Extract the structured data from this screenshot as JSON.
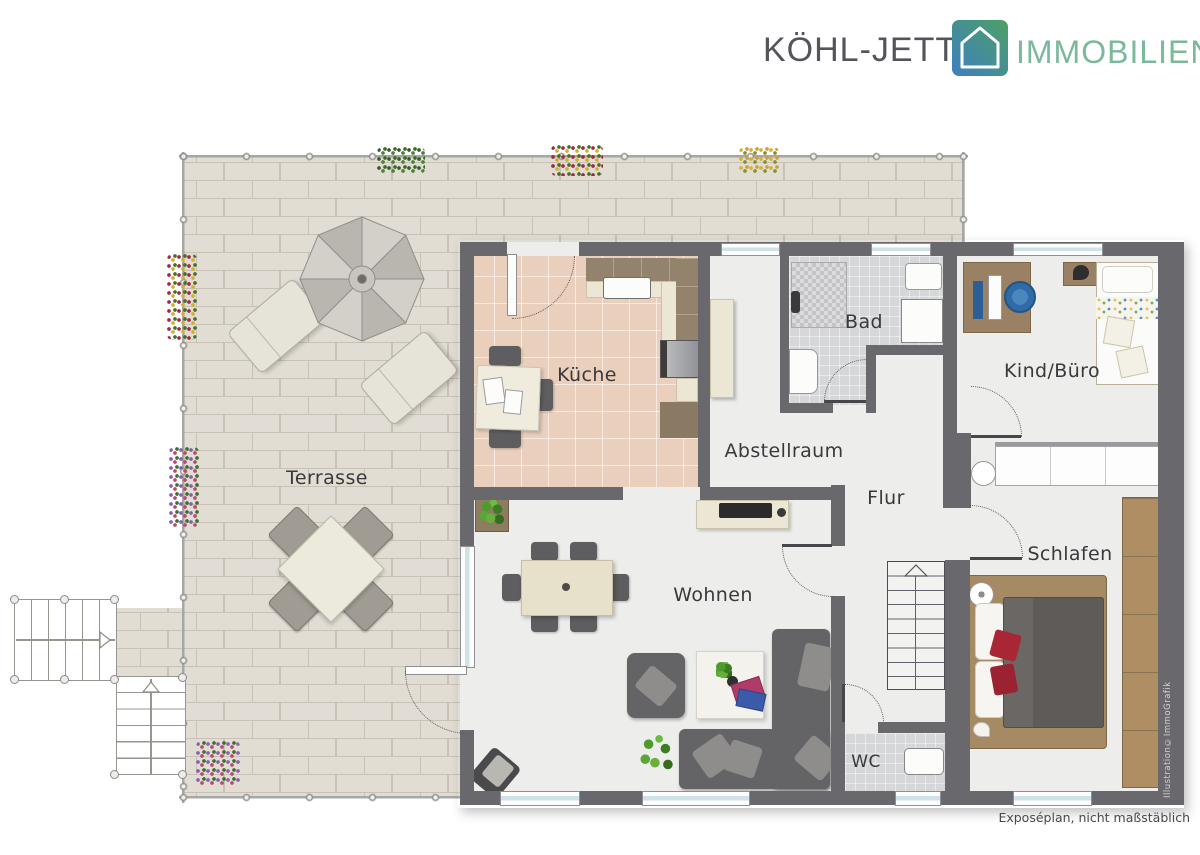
{
  "meta": {
    "width": 1200,
    "height": 855,
    "kind": "real-estate floor plan"
  },
  "logo": {
    "brand": "KÖHL-JETTER",
    "suffix": "IMMOBILIEN",
    "colors": {
      "brand_text": "#54555a",
      "suffix_text": "#7bb89c",
      "icon_gradient_start": "#3e7fc0",
      "icon_gradient_end": "#4d9f66"
    }
  },
  "floor_plan": {
    "wall_color": "#69686d",
    "label_color": "#39393b",
    "rooms": [
      {
        "id": "terrasse",
        "label": "Terrasse"
      },
      {
        "id": "kueche",
        "label": "Küche"
      },
      {
        "id": "bad",
        "label": "Bad"
      },
      {
        "id": "kind_buero",
        "label": "Kind/Büro"
      },
      {
        "id": "abstellraum",
        "label": "Abstellraum"
      },
      {
        "id": "flur",
        "label": "Flur"
      },
      {
        "id": "wohnen",
        "label": "Wohnen"
      },
      {
        "id": "schlafen",
        "label": "Schlafen"
      },
      {
        "id": "wc",
        "label": "WC"
      }
    ]
  },
  "annotations": {
    "watermark": "Illustration©ImmoGrafik",
    "footer_note": "Exposéplan, nicht maßstäblich"
  }
}
